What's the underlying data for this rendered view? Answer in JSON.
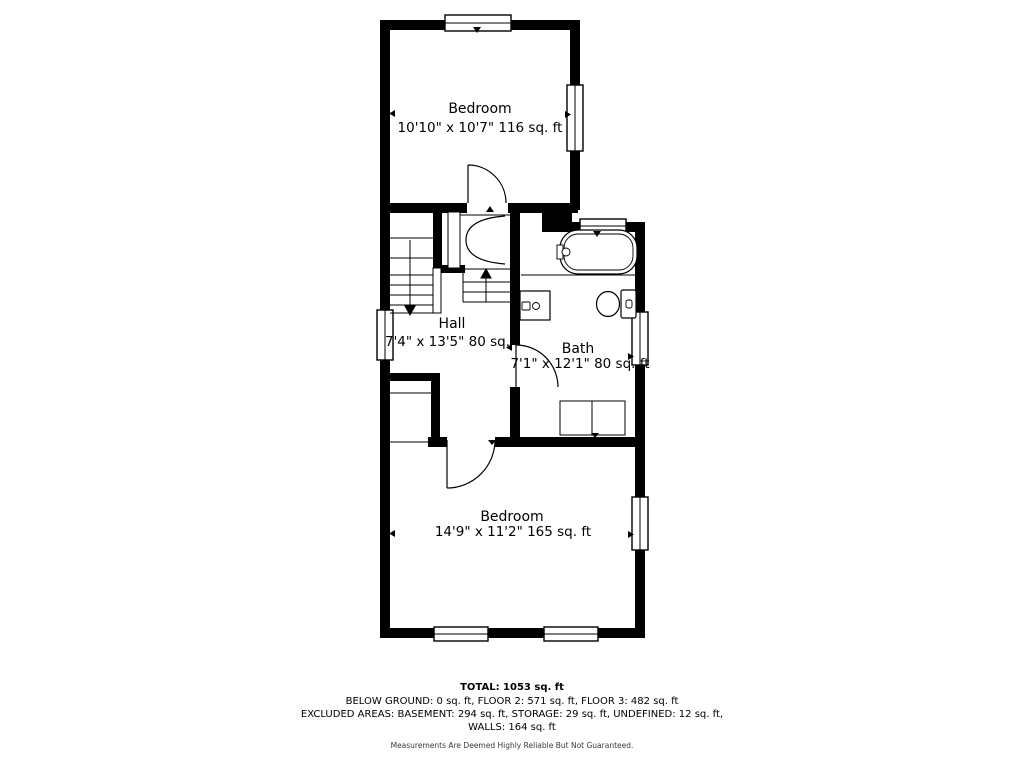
{
  "plan": {
    "background": "#ffffff",
    "wall_color": "#000000",
    "rooms": [
      {
        "name": "Bedroom",
        "dims": "10'10\" x 10'7\" 116 sq. ft"
      },
      {
        "name": "Hall",
        "dims": "7'4\" x 13'5\" 80 sq. ft"
      },
      {
        "name": "Bath",
        "dims": "7'1\" x 12'1\" 80 sq. ft"
      },
      {
        "name": "Bedroom",
        "dims": "14'9\" x 11'2\" 165 sq. ft"
      }
    ]
  },
  "summary": {
    "total": "TOTAL: 1053 sq. ft",
    "floors_line": "BELOW GROUND: 0 sq. ft, FLOOR 2: 571 sq. ft, FLOOR 3: 482 sq. ft",
    "excluded_line": "EXCLUDED AREAS: BASEMENT: 294 sq. ft, STORAGE: 29 sq. ft, UNDEFINED: 12 sq. ft,",
    "walls_line": "WALLS: 164 sq. ft",
    "disclaimer": "Measurements Are Deemed Highly Reliable But Not Guaranteed."
  }
}
